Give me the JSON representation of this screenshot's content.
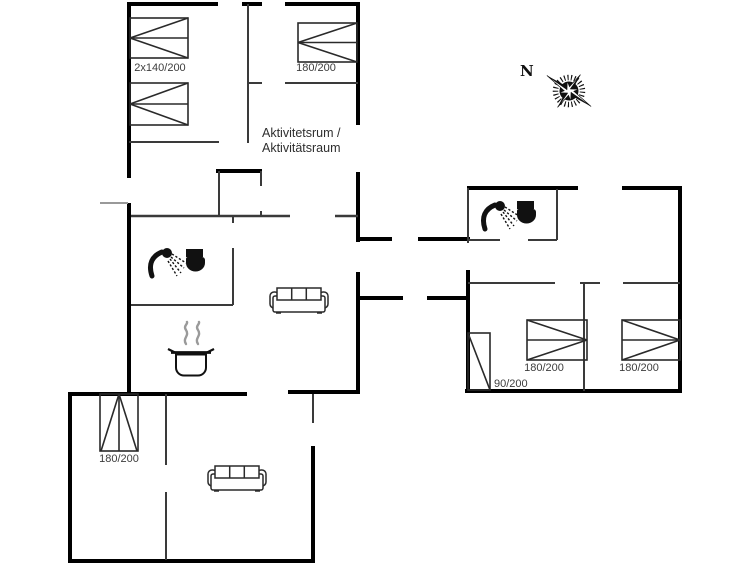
{
  "document": {
    "type": "holiday-house floor plan",
    "compass_north": "N"
  },
  "rooms": {
    "activity_room_line1": "Aktivitetsrum /",
    "activity_room_line2": "Aktivitätsraum"
  },
  "beds": {
    "double_top_left": "2x140/200",
    "single_top_middle": "180/200",
    "single_annex": "180/200",
    "single_right_room1": "180/200",
    "single_right_room2": "180/200",
    "single_hall": "90/200"
  },
  "icons": {
    "shower": "shower-icon",
    "toilet": "toilet-icon",
    "sofa": "sofa-icon",
    "cooking_pot": "cooking-pot-icon",
    "compass": "compass-rose-icon"
  },
  "colors": {
    "wall_exterior": "#000000",
    "wall_interior": "#3a3a3a",
    "window_tick": "#999999",
    "label_text": "#3d3d3d",
    "icon_fill": "#111111",
    "background": "#ffffff"
  }
}
